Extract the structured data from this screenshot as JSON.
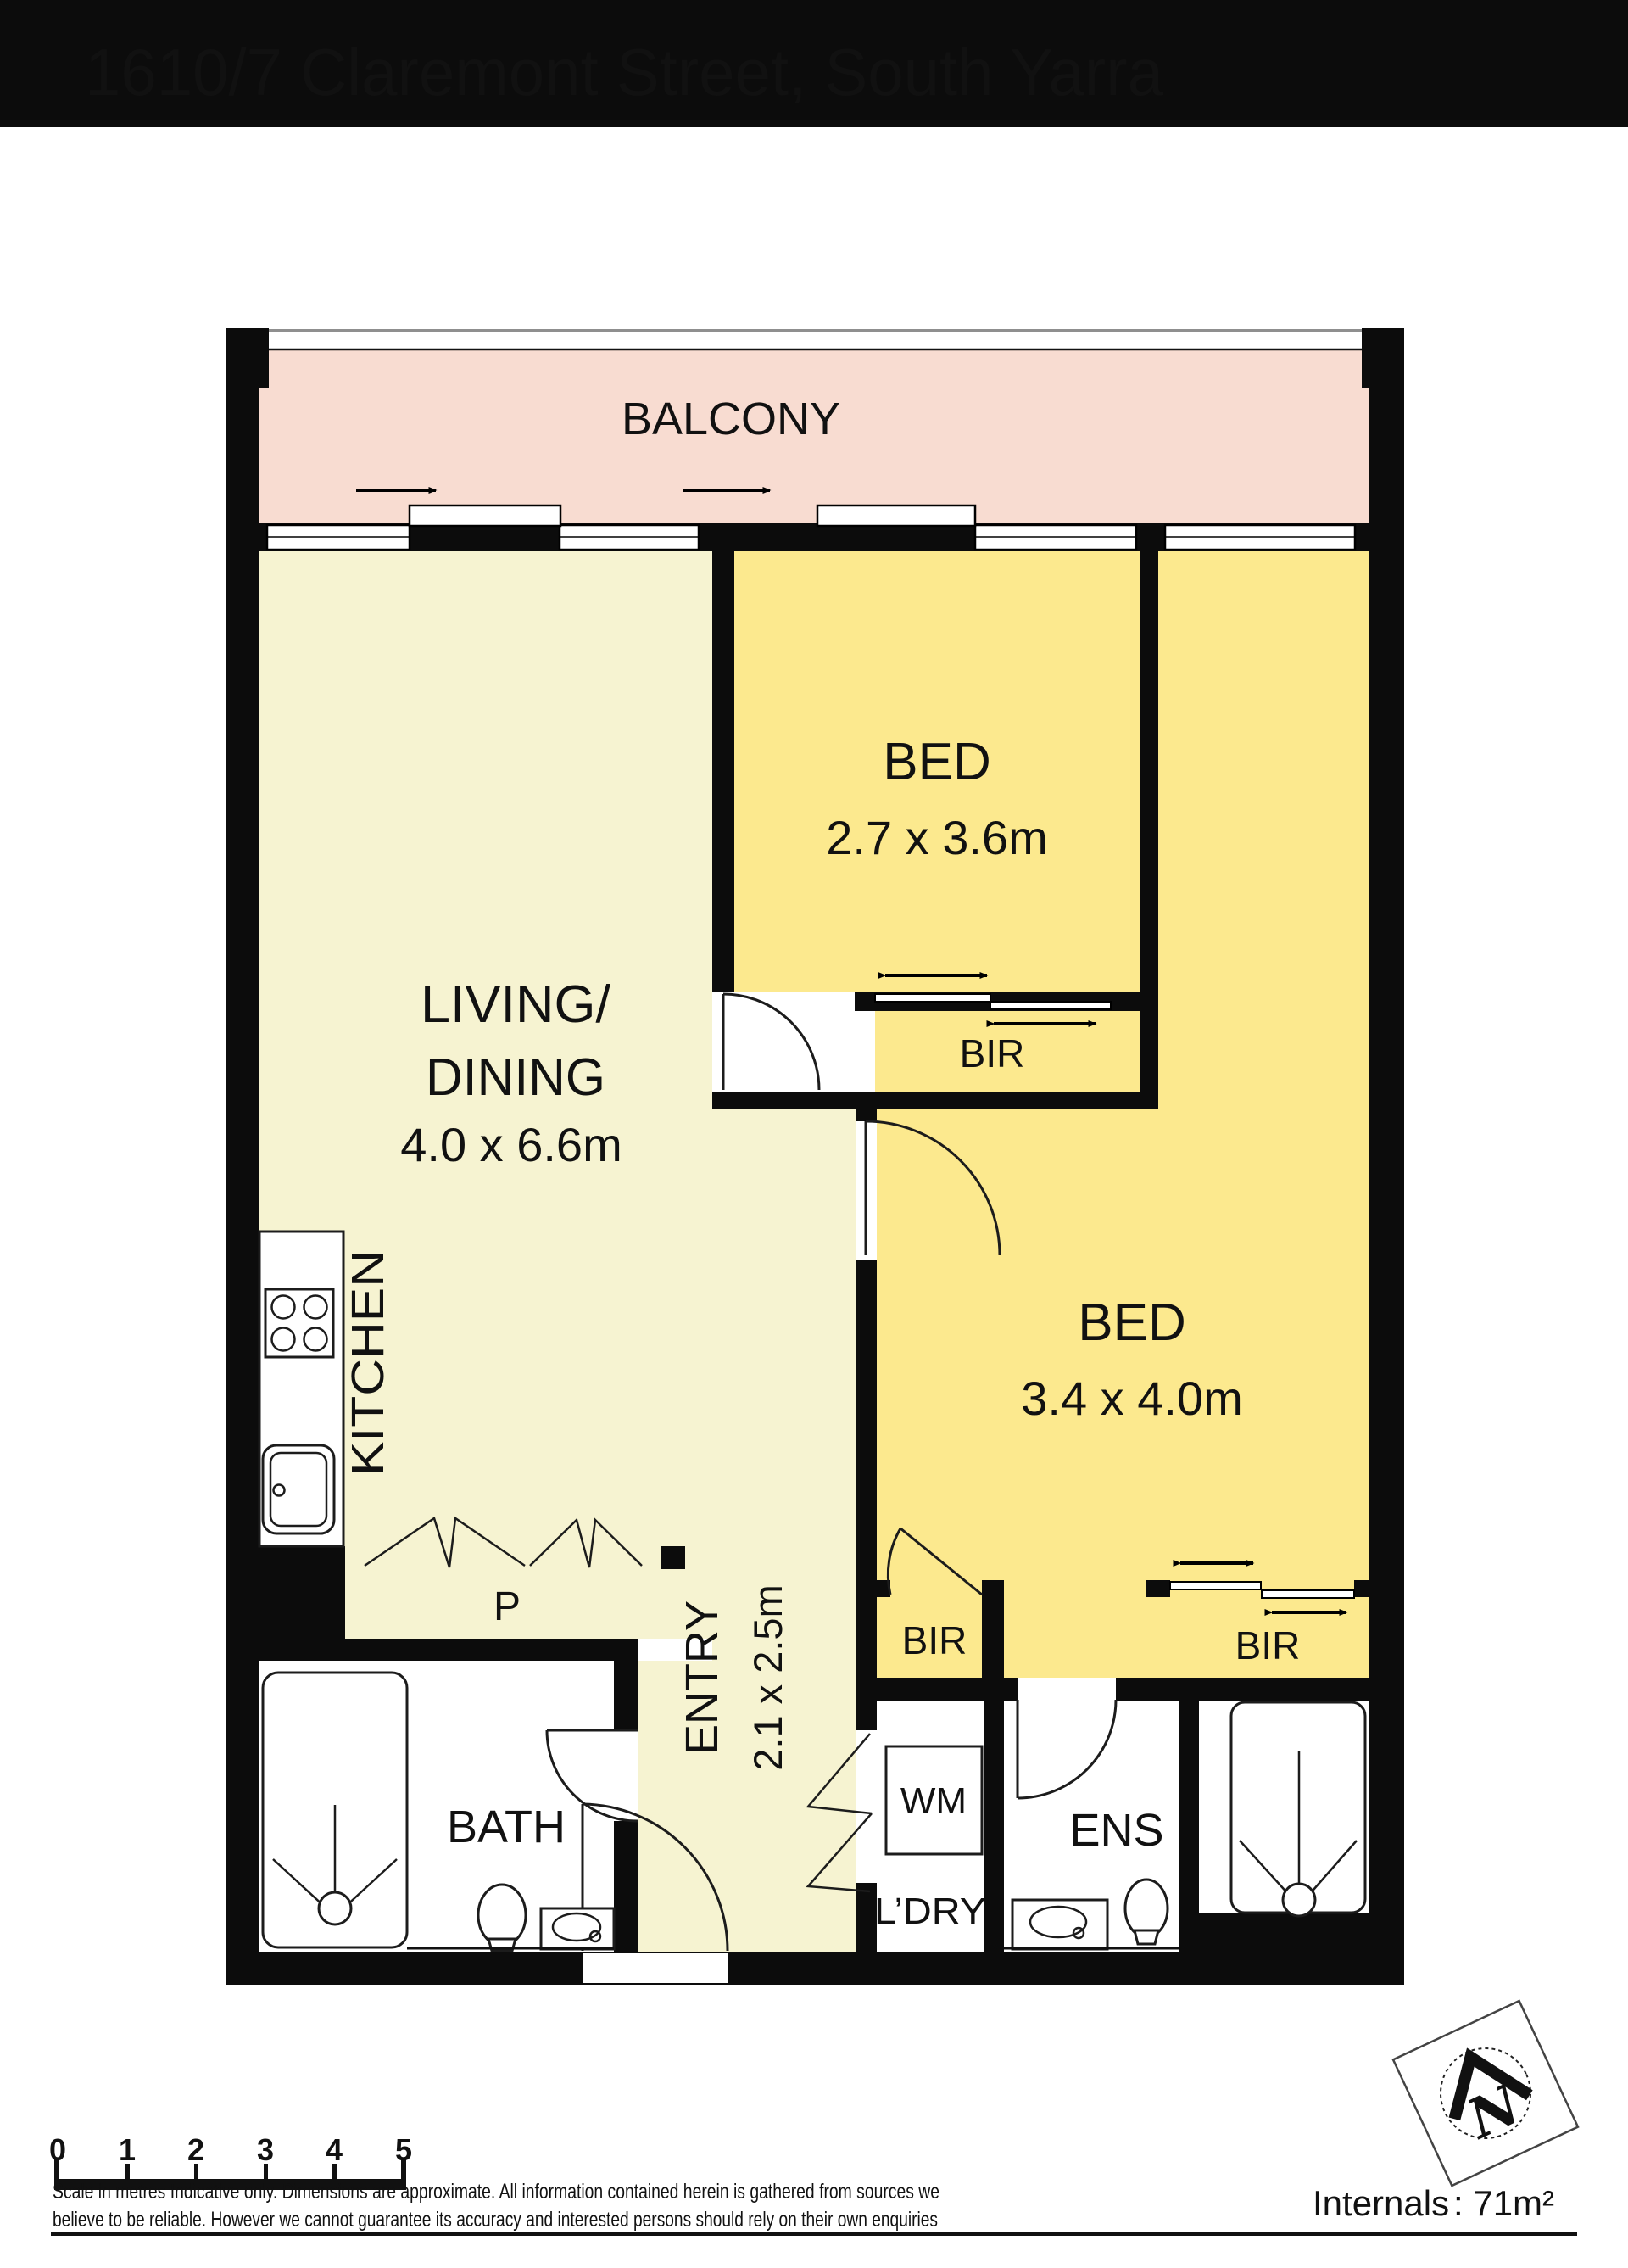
{
  "title": "1610/7 Claremont Street, South Yarra",
  "colors": {
    "wall": "#0c0c0c",
    "line": "#1c1c1c",
    "balcony": "#f8dcd1",
    "bed": "#fce98e",
    "living": "#f6f3d1",
    "paper": "#ffffff",
    "header_text": "#ffffff"
  },
  "rooms": {
    "balcony": {
      "label": "BALCONY"
    },
    "living": {
      "line1": "LIVING/",
      "line2": "DINING",
      "dims": "4.0 x 6.6m"
    },
    "kitchen": {
      "label": "KITCHEN"
    },
    "pantry": {
      "label": "P"
    },
    "bed1": {
      "label": "BED",
      "dims": "2.7 x 3.6m"
    },
    "bed2": {
      "label": "BED",
      "dims": "3.4 x 4.0m"
    },
    "bir_bed1": {
      "label": "BIR"
    },
    "bir_bed2_left": {
      "label": "BIR"
    },
    "bir_bed2_right": {
      "label": "BIR"
    },
    "bath": {
      "label": "BATH"
    },
    "entry": {
      "label": "ENTRY",
      "dims": "2.1 x 2.5m"
    },
    "laundry": {
      "appliance": "WM",
      "label": "L’DRY"
    },
    "ensuite": {
      "label": "ENS"
    }
  },
  "compass": {
    "label": "N"
  },
  "scalebar": {
    "ticks": [
      "0",
      "1",
      "2",
      "3",
      "4",
      "5"
    ]
  },
  "disclaimer": {
    "line1": "Scale in metres Indicative only. Dimensions are approximate. All information contained herein is gathered from sources we",
    "line2": "believe to be reliable. However we cannot guarantee its accuracy and interested persons should rely on their own enquiries"
  },
  "footer": {
    "area_label": "Internals",
    "area_value": ": 71m²"
  }
}
